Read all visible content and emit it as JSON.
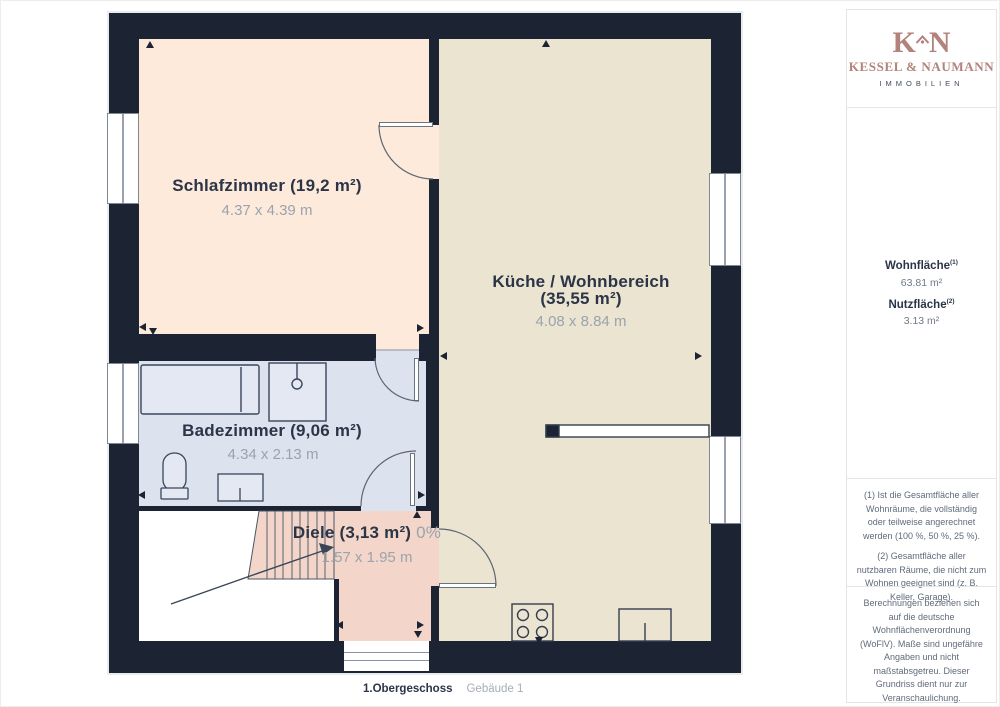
{
  "plan": {
    "rooms": {
      "schlafzimmer": {
        "title": "Schlafzimmer (19,2 m²)",
        "dims": "4.37 x 4.39 m"
      },
      "kueche": {
        "title_line1": "Küche / Wohnbereich",
        "title_line2": "(35,55 m²)",
        "dims": "4.08 x 8.84 m"
      },
      "badezimmer": {
        "title": "Badezimmer (9,06 m²)",
        "dims": "4.34 x 2.13 m"
      },
      "diele": {
        "title": "Diele (3,13 m²)",
        "share": "0%",
        "dims": "1.57 x 1.95 m"
      }
    },
    "colors": {
      "wall": "#1c2433",
      "schlafzimmer": "#fdeadb",
      "kueche": "#ebe4d1",
      "badezimmer": "#dde3ee",
      "diele": "#f3d6c9",
      "void": "#ffffff"
    }
  },
  "footer": {
    "floor": "1.Obergeschoss",
    "building": "Gebäude 1"
  },
  "sidebar": {
    "logo": {
      "letter_k": "K",
      "letter_n": "N",
      "brand": "KESSEL & NAUMANN",
      "subtitle": "IMMOBILIEN",
      "accent": "#b2837b"
    },
    "stats": [
      {
        "label": "Wohnfläche",
        "sup": "(1)",
        "value": "63.81 m²"
      },
      {
        "label": "Nutzfläche",
        "sup": "(2)",
        "value": "3.13 m²"
      }
    ],
    "footnotes": [
      "(1) Ist die Gesamtfläche aller Wohnräume, die vollständig oder teilweise angerechnet werden (100 %, 50 %, 25 %).",
      "(2) Gesamtfläche aller nutzbaren Räume, die nicht zum Wohnen geeignet sind (z. B. Keller, Garage)."
    ],
    "disclaimer": "Berechnungen beziehen sich auf die deutsche Wohnflächenverordnung (WoFlV). Maße sind ungefähre Angaben und nicht maßstabsgetreu. Dieser Grundriss dient nur zur Veranschaulichung.",
    "brand_mark": {
      "name": "GIRAFFE",
      "num": "360"
    }
  }
}
